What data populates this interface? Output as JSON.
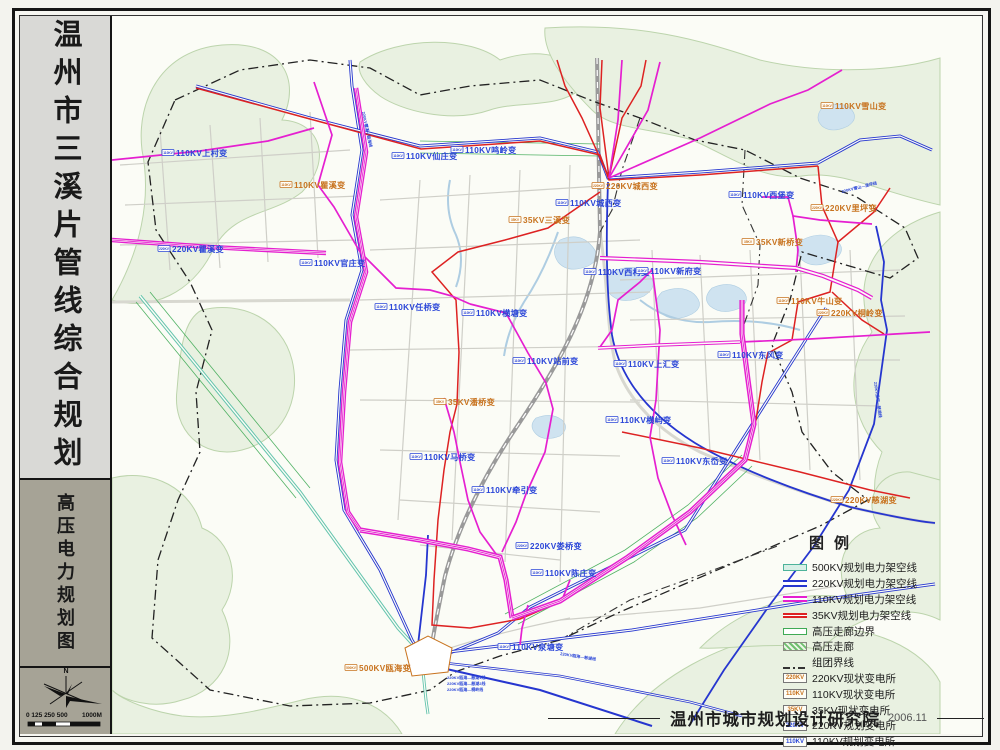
{
  "sidebar": {
    "title": "温州市三溪片管线综合规划",
    "subtitle": "高压电力规划图",
    "north_label": "N",
    "scale_ticks": "0 125 250  500",
    "scale_end": "1000M"
  },
  "legend": {
    "title": "图例",
    "items": [
      {
        "label": "500KV规划电力架空线",
        "swatch": "line-500"
      },
      {
        "label": "220KV规划电力架空线",
        "swatch": "line-220"
      },
      {
        "label": "110KV规划电力架空线",
        "swatch": "line-110"
      },
      {
        "label": "35KV规划电力架空线",
        "swatch": "line-35"
      },
      {
        "label": "高压走廊边界",
        "swatch": "corridor-edge"
      },
      {
        "label": "高压走廊",
        "swatch": "corridor"
      },
      {
        "label": "组团界线",
        "swatch": "cluster-boundary"
      },
      {
        "label": "220KV现状变电所",
        "swatch": "box",
        "box_text": "220KV",
        "box_color": "existing"
      },
      {
        "label": "110KV现状变电所",
        "swatch": "box",
        "box_text": "110KV",
        "box_color": "existing"
      },
      {
        "label": "35KV现状变电所",
        "swatch": "box",
        "box_text": "35KV",
        "box_color": "existing"
      },
      {
        "label": "220KV规划变电所",
        "swatch": "box",
        "box_text": "220KV",
        "box_color": "planned"
      },
      {
        "label": "110KV规划变电所",
        "swatch": "box",
        "box_text": "110KV",
        "box_color": "planned"
      }
    ]
  },
  "credit": {
    "institute": "温州市城市规划设计研究院",
    "date": "2006.11"
  },
  "colors": {
    "magenta": "#e51fd0",
    "blue": "#2636cf",
    "red": "#dd2222",
    "teal": "#63c4ad",
    "green": "#3faa55",
    "existing": "#c8731f",
    "planned": "#2b46d8",
    "boundary": "#222222"
  },
  "map": {
    "substations": [
      {
        "name": "110KV上村变",
        "v": "110KV",
        "type": "planned",
        "x": 176,
        "y": 156
      },
      {
        "name": "220KV瞿溪变",
        "v": "220KV",
        "type": "planned",
        "x": 172,
        "y": 252
      },
      {
        "name": "110KV官庄变",
        "v": "110KV",
        "type": "planned",
        "x": 314,
        "y": 266
      },
      {
        "name": "110KV仙庄变",
        "v": "110KV",
        "type": "planned",
        "x": 406,
        "y": 159
      },
      {
        "name": "110KV鸣岭变",
        "v": "110KV",
        "type": "planned",
        "x": 465,
        "y": 153
      },
      {
        "name": "110KV城西变",
        "v": "110KV",
        "type": "planned",
        "x": 570,
        "y": 206
      },
      {
        "name": "110KV西村变",
        "v": "110KV",
        "type": "planned",
        "x": 598,
        "y": 275
      },
      {
        "name": "110KV新府变",
        "v": "110KV",
        "type": "planned",
        "x": 650,
        "y": 274
      },
      {
        "name": "110KV任桥变",
        "v": "110KV",
        "type": "planned",
        "x": 389,
        "y": 310
      },
      {
        "name": "110KV横塘变",
        "v": "110KV",
        "type": "planned",
        "x": 476,
        "y": 316
      },
      {
        "name": "110KV站前变",
        "v": "110KV",
        "type": "planned",
        "x": 527,
        "y": 364
      },
      {
        "name": "110KV上汇变",
        "v": "110KV",
        "type": "planned",
        "x": 628,
        "y": 367
      },
      {
        "name": "110KV东风变",
        "v": "110KV",
        "type": "planned",
        "x": 732,
        "y": 358
      },
      {
        "name": "110KV西堡变",
        "v": "110KV",
        "type": "planned",
        "x": 743,
        "y": 198
      },
      {
        "name": "110KV横屿变",
        "v": "110KV",
        "type": "planned",
        "x": 620,
        "y": 423
      },
      {
        "name": "110KV东岙变",
        "v": "110KV",
        "type": "planned",
        "x": 676,
        "y": 464
      },
      {
        "name": "110KV马桥变",
        "v": "110KV",
        "type": "planned",
        "x": 424,
        "y": 460
      },
      {
        "name": "110KV牵引变",
        "v": "110KV",
        "type": "planned",
        "x": 486,
        "y": 493
      },
      {
        "name": "220KV娄桥变",
        "v": "220KV",
        "type": "planned",
        "x": 530,
        "y": 549
      },
      {
        "name": "110KV陈庄变",
        "v": "110KV",
        "type": "planned",
        "x": 545,
        "y": 576
      },
      {
        "name": "110KV泉塘变",
        "v": "110KV",
        "type": "planned",
        "x": 512,
        "y": 650
      },
      {
        "name": "110KV瞿溪变",
        "v": "110KV",
        "type": "existing",
        "x": 294,
        "y": 188
      },
      {
        "name": "220KV城西变",
        "v": "220KV",
        "type": "existing",
        "x": 606,
        "y": 189
      },
      {
        "name": "35KV三溪变",
        "v": "35KV",
        "type": "existing",
        "x": 523,
        "y": 223
      },
      {
        "name": "110KV雪山变",
        "v": "110KV",
        "type": "existing",
        "x": 835,
        "y": 109
      },
      {
        "name": "220KV里坪变",
        "v": "220KV",
        "type": "existing",
        "x": 825,
        "y": 211
      },
      {
        "name": "35KV新桥变",
        "v": "35KV",
        "type": "existing",
        "x": 756,
        "y": 245
      },
      {
        "name": "110KV牛山变",
        "v": "110KV",
        "type": "existing",
        "x": 791,
        "y": 304
      },
      {
        "name": "220KV桐岭变",
        "v": "220KV",
        "type": "existing",
        "x": 831,
        "y": 316
      },
      {
        "name": "35KV潘桥变",
        "v": "35KV",
        "type": "existing",
        "x": 448,
        "y": 405
      },
      {
        "name": "500KV瓯海变",
        "v": "500KV",
        "type": "existing",
        "x": 359,
        "y": 671
      },
      {
        "name": "220KV慈湖变",
        "v": "220KV",
        "type": "existing",
        "x": 845,
        "y": 503
      }
    ],
    "line_labels": [
      {
        "text": "220KV瞿溪—瓯海线",
        "x": 362,
        "y": 112,
        "rot": 78
      },
      {
        "text": "220KV雪山—里坪线",
        "x": 842,
        "y": 193,
        "rot": -14
      },
      {
        "text": "220KV里坪—慈湖线",
        "x": 874,
        "y": 382,
        "rot": 82
      },
      {
        "text": "220KV瓯海—慈湖1线",
        "x": 447,
        "y": 679,
        "rot": 0
      },
      {
        "text": "220KV瓯海—慈湖2线",
        "x": 447,
        "y": 685,
        "rot": 0
      },
      {
        "text": "220KV瓯海—桐岭线",
        "x": 447,
        "y": 691,
        "rot": 0
      },
      {
        "text": "220KV瓯海—慈湖线",
        "x": 560,
        "y": 655,
        "rot": 9
      }
    ]
  }
}
